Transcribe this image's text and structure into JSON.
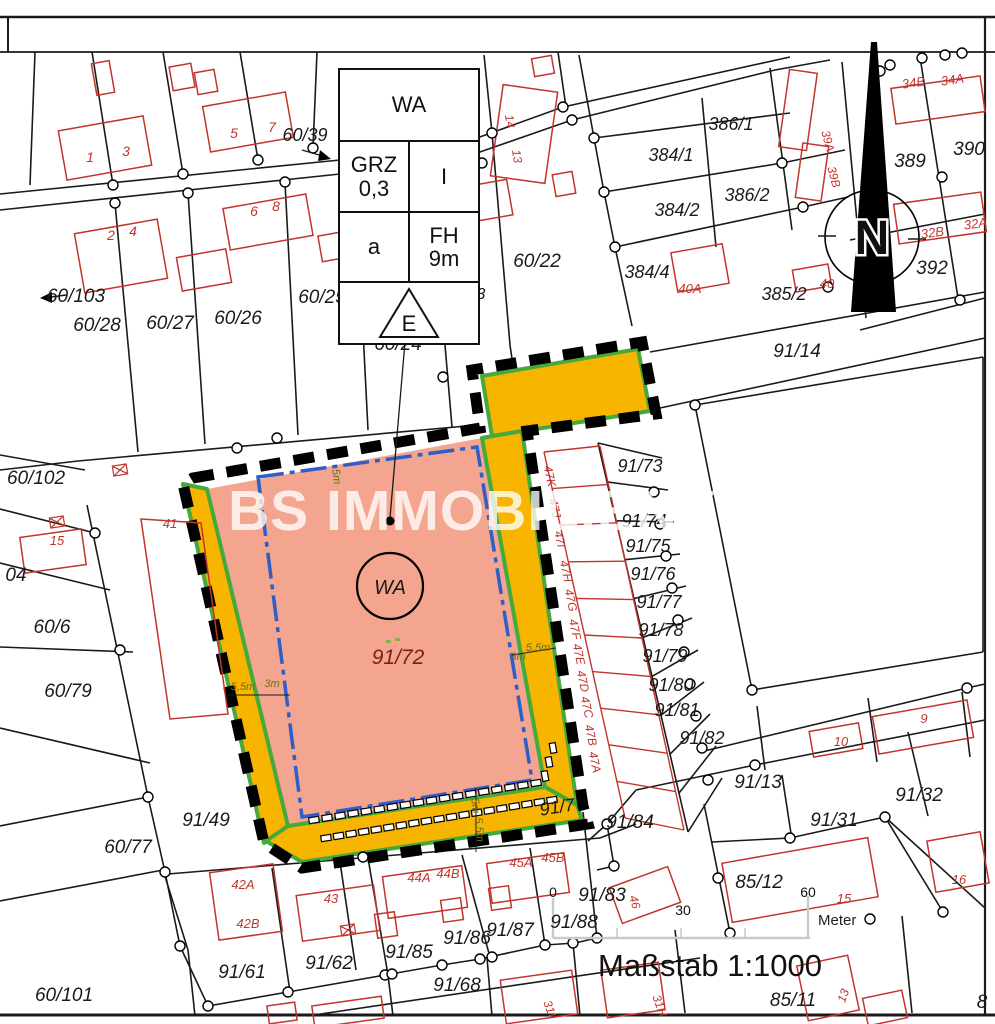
{
  "legend": {
    "wa": "WA",
    "grz": "GRZ",
    "grz_val": "0,3",
    "floors": "I",
    "bauweise": "a",
    "fh": "FH",
    "fh_val": "9m",
    "e": "E"
  },
  "watermark": "BS IMMOBILIENKONTOR",
  "north": "N",
  "scale": {
    "label": "Maßstab  1:1000",
    "unit": "Meter",
    "ticks": [
      "0",
      "30",
      "60"
    ]
  },
  "colors": {
    "area_fill": "#F3A58F",
    "strip_fill": "#F7B500",
    "strip_edge": "#46A93C",
    "baugrenze_blue": "#2E5EC8",
    "cadastre_black": "#1a1a1a",
    "building_red": "#C2342C",
    "label_maroon": "#7A1D1D",
    "dim_olive": "#6E6E14",
    "scalebar_gray": "#C9C9C9"
  },
  "central_area": {
    "use": "WA",
    "parcel": "91/72",
    "road_parcel": "91/7"
  },
  "labels": [
    [
      "60/39",
      305,
      141,
      18
    ],
    [
      "1",
      90,
      162,
      14,
      "r"
    ],
    [
      "3",
      126,
      156,
      14,
      "r"
    ],
    [
      "5",
      234,
      138,
      14,
      "r"
    ],
    [
      "7",
      272,
      132,
      14,
      "r"
    ],
    [
      "2",
      111,
      240,
      14,
      "r"
    ],
    [
      "4",
      133,
      236,
      14,
      "r"
    ],
    [
      "6",
      254,
      216,
      14,
      "r"
    ],
    [
      "8",
      276,
      211,
      14,
      "r"
    ],
    [
      "60/103",
      76,
      302,
      19
    ],
    [
      "60/28",
      97,
      331,
      19
    ],
    [
      "60/27",
      170,
      329,
      19
    ],
    [
      "60/26",
      238,
      324,
      19
    ],
    [
      "60/25",
      322,
      303,
      19
    ],
    [
      "60/24",
      398,
      350,
      19
    ],
    [
      "3",
      481,
      299,
      16
    ],
    [
      "60/22",
      537,
      267,
      19
    ],
    [
      "14",
      506,
      122,
      12,
      "r",
      80
    ],
    [
      "13",
      513,
      157,
      12,
      "r",
      80
    ],
    [
      "60/102",
      36,
      484,
      19
    ],
    [
      "04",
      16,
      581,
      19
    ],
    [
      "15",
      57,
      545,
      13,
      "r"
    ],
    [
      "41",
      170,
      528,
      13,
      "r"
    ],
    [
      "60/6",
      52,
      633,
      19
    ],
    [
      "60/79",
      68,
      697,
      19
    ],
    [
      "60/77",
      128,
      853,
      19
    ],
    [
      "91/49",
      206,
      826,
      19
    ],
    [
      "60/101",
      64,
      1001,
      19
    ],
    [
      "384/1",
      671,
      161,
      18
    ],
    [
      "386/1",
      731,
      130,
      18
    ],
    [
      "384/2",
      677,
      216,
      18
    ],
    [
      "386/2",
      747,
      201,
      18
    ],
    [
      "384/4",
      647,
      278,
      18
    ],
    [
      "385/2",
      784,
      300,
      18
    ],
    [
      "40A",
      690,
      293,
      13,
      "r"
    ],
    [
      "40",
      827,
      288,
      13,
      "r"
    ],
    [
      "39A",
      824,
      142,
      12,
      "r",
      75
    ],
    [
      "39B",
      830,
      178,
      12,
      "r",
      75
    ],
    [
      "34B",
      914,
      87,
      13,
      "r",
      -8
    ],
    [
      "34A",
      953,
      84,
      13,
      "r",
      -8
    ],
    [
      "389",
      910,
      167,
      19
    ],
    [
      "390",
      969,
      155,
      19
    ],
    [
      "392",
      932,
      274,
      19
    ],
    [
      "32B",
      933,
      237,
      13,
      "r",
      -8
    ],
    [
      "32A",
      976,
      228,
      13,
      "r",
      -8
    ],
    [
      "91/14",
      797,
      357,
      19
    ],
    [
      "91/73",
      640,
      472,
      18
    ],
    [
      "91/74",
      644,
      527,
      18
    ],
    [
      "91/75",
      648,
      552,
      18
    ],
    [
      "91/76",
      653,
      580,
      18
    ],
    [
      "91/77",
      659,
      608,
      18
    ],
    [
      "91/78",
      661,
      636,
      18
    ],
    [
      "91/79",
      665,
      662,
      18
    ],
    [
      "91/80",
      671,
      691,
      18
    ],
    [
      "91/81",
      677,
      716,
      18
    ],
    [
      "91/82",
      702,
      744,
      18
    ],
    [
      "47K",
      546,
      477,
      12,
      "r",
      78
    ],
    [
      "47J",
      551,
      509,
      12,
      "r",
      78
    ],
    [
      "47I",
      556,
      540,
      12,
      "r",
      78
    ],
    [
      "47H",
      562,
      572,
      12,
      "r",
      78
    ],
    [
      "47G",
      567,
      601,
      12,
      "r",
      78
    ],
    [
      "47F",
      571,
      630,
      12,
      "r",
      78
    ],
    [
      "47E",
      575,
      655,
      12,
      "r",
      78
    ],
    [
      "47D",
      579,
      682,
      12,
      "r",
      78
    ],
    [
      "47C",
      583,
      708,
      12,
      "r",
      78
    ],
    [
      "47B",
      587,
      736,
      12,
      "r",
      78
    ],
    [
      "47A",
      591,
      763,
      12,
      "r",
      78
    ],
    [
      "WA",
      390,
      594,
      20
    ],
    [
      "91/72",
      398,
      664,
      21,
      "m"
    ],
    [
      "91/7",
      558,
      813,
      18,
      "k",
      -9
    ],
    [
      "5m",
      333,
      477,
      11,
      "o",
      83
    ],
    [
      "5,5m",
      243,
      690,
      11,
      "o"
    ],
    [
      "3m",
      272,
      687,
      11,
      "o"
    ],
    [
      "5,5m",
      538,
      651,
      11,
      "o"
    ],
    [
      "3m",
      518,
      660,
      11,
      "o"
    ],
    [
      "5m",
      472,
      806,
      11,
      "o",
      85
    ],
    [
      "5,5m",
      476,
      830,
      11,
      "o",
      85
    ],
    [
      "42A",
      243,
      889,
      13,
      "r"
    ],
    [
      "42B",
      248,
      928,
      13,
      "r"
    ],
    [
      "43",
      331,
      903,
      13,
      "r"
    ],
    [
      "44A",
      419,
      882,
      13,
      "r"
    ],
    [
      "44B",
      448,
      878,
      13,
      "r"
    ],
    [
      "45A",
      521,
      867,
      13,
      "r"
    ],
    [
      "45B",
      553,
      862,
      13,
      "r"
    ],
    [
      "91/61",
      242,
      978,
      19
    ],
    [
      "91/62",
      329,
      969,
      19
    ],
    [
      "91/85",
      409,
      958,
      19
    ],
    [
      "91/86",
      467,
      944,
      19
    ],
    [
      "91/87",
      510,
      936,
      19
    ],
    [
      "91/88",
      574,
      928,
      19
    ],
    [
      "91/68",
      457,
      991,
      19
    ],
    [
      "31I",
      546,
      1010,
      12,
      "r",
      70
    ],
    [
      "31H",
      656,
      1007,
      12,
      "r",
      70
    ],
    [
      "91/83",
      602,
      901,
      19
    ],
    [
      "46",
      631,
      903,
      12,
      "r",
      75
    ],
    [
      "91/84",
      630,
      828,
      19
    ],
    [
      "91/13",
      758,
      788,
      19
    ],
    [
      "91/31",
      834,
      826,
      19
    ],
    [
      "91/32",
      919,
      801,
      19
    ],
    [
      "85/12",
      759,
      888,
      19
    ],
    [
      "85/11",
      793,
      1006,
      19
    ],
    [
      "9",
      924,
      723,
      13,
      "r"
    ],
    [
      "10",
      841,
      746,
      13,
      "r"
    ],
    [
      "15",
      844,
      903,
      13,
      "r"
    ],
    [
      "16",
      959,
      884,
      13,
      "r"
    ],
    [
      "13",
      847,
      997,
      12,
      "r",
      -70
    ],
    [
      "8",
      982,
      1008,
      19
    ]
  ]
}
